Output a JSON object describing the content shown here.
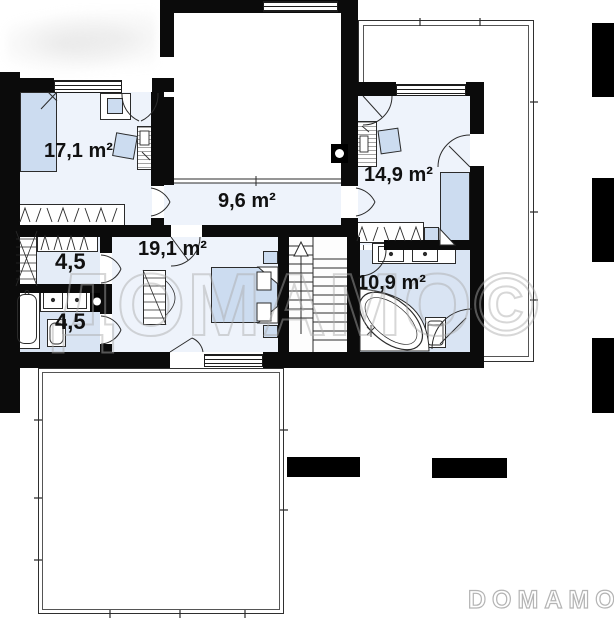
{
  "plan_type": "floor-plan",
  "rooms": [
    {
      "id": "bedroom-left",
      "area_label": "17,1 m²"
    },
    {
      "id": "hallway",
      "area_label": "9,6 m²"
    },
    {
      "id": "bedroom-right",
      "area_label": "14,9 m²"
    },
    {
      "id": "bedroom-master",
      "area_label": "19,1 m²"
    },
    {
      "id": "wardrobe-room",
      "area_label": "4,5"
    },
    {
      "id": "bathroom-small",
      "area_label": "4,5"
    },
    {
      "id": "bathroom-main",
      "area_label": "10,9 m²"
    }
  ],
  "watermark": {
    "center_text": "ДОМАМО©",
    "footer_text": "DOMAMO"
  },
  "features": [
    "stairs-up",
    "terrace-right",
    "terrace-bottom",
    "void-room",
    "corner-bathtub",
    "corner-shower",
    "double-sinks",
    "wardrobes"
  ],
  "colors": {
    "wall": "#0b0b0b",
    "room_tint": "#eef3fb",
    "wet_room_tint": "#d9e4f3",
    "closet_tint": "#e4ecf7",
    "furniture_blue": "#ccdcf0",
    "watermark_gray": "#c9c9c9"
  }
}
